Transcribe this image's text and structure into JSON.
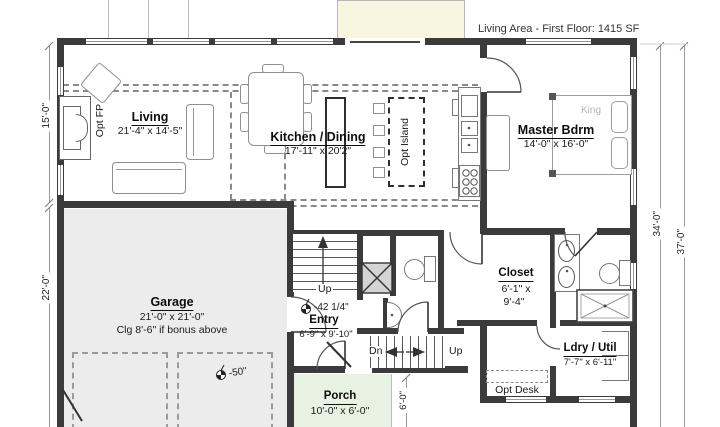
{
  "header": {
    "living_area_label": "Living Area - First Floor: 1415 SF"
  },
  "rooms": {
    "living": {
      "name": "Living",
      "dims": "21'-4\" x 14'-5\""
    },
    "kitchen_dining": {
      "name": "Kitchen / Dining",
      "dims": "17'-11\" x 20'2\""
    },
    "master_bedroom": {
      "name": "Master Bdrm",
      "dims": "14'-0\" x 16'-0\""
    },
    "garage": {
      "name": "Garage",
      "dims": "21'-0\" x 21'-0\"",
      "note": "Clg 8'-6\" if bonus above"
    },
    "entry": {
      "name": "Entry",
      "dims": "6'-9\" x 9'-10\""
    },
    "closet": {
      "name": "Closet",
      "dims_line1": "6'-1\" x",
      "dims_line2": "9'-4\""
    },
    "laundry_utility": {
      "name": "Ldry / Util",
      "dims": "7'-7\" x 6'-11\""
    },
    "porch": {
      "name": "Porch",
      "dims": "10'-0\" x 6'-0\""
    }
  },
  "annotations": {
    "opt_fireplace": "Opt FP",
    "opt_island": "Opt Island",
    "opt_desk": "Opt Desk",
    "bed_size": "King",
    "stairs_up_entry": "Up",
    "stairs_dn_lower": "Dn",
    "stairs_up_lower": "Up",
    "floor_elevation_entry": "-42 1/4\"",
    "floor_elevation_garage": "-50\""
  },
  "dimensions": {
    "left_upper": "15'-0\"",
    "left_lower": "22'-0\"",
    "right_inner": "34'-0\"",
    "right_outer": "37'-0\"",
    "porch_depth": "6'-0\""
  },
  "colors": {
    "wall": "#3b3b3b",
    "garage_floor": "#ececec",
    "porch_floor": "#e7f2e3",
    "deck_fill": "#f8f5e1",
    "dimension_line": "#9a9a9a",
    "king_label": "#b3b3b3"
  }
}
